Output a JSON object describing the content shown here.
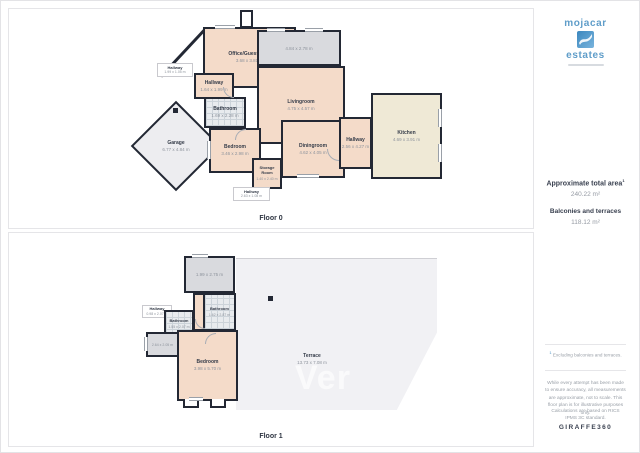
{
  "colors": {
    "wall": "#232834",
    "room_peach": "#f4dbc9",
    "kitchen_cream": "#efe9d6",
    "tile_grey": "#e8ebee",
    "balcony_grey": "#d9dade",
    "terrace_grey": "#f1f1f4",
    "brand_blue": "#4f95c6"
  },
  "floor0": {
    "label": "Floor 0",
    "rooms": {
      "office": {
        "name": "Office/Guestroom",
        "dims": "3.68 x 3.81 m"
      },
      "terrace_top": {
        "dims": "4.84 x 2.78 m"
      },
      "hallway_left": {
        "name": "Hallway",
        "dims": "1.99 x 1.05 m"
      },
      "hallway_small": {
        "name": "Hallway",
        "dims": "1.64 x 1.99 m"
      },
      "bathroom": {
        "name": "Bathroom",
        "dims": "1.69 x 2.28 m"
      },
      "garage": {
        "name": "Garage",
        "dims": "6.77 x 4.84 m"
      },
      "bedroom": {
        "name": "Bedroom",
        "dims": "3.46 x 2.98 m"
      },
      "livingroom": {
        "name": "Livingroom",
        "dims": "4.75 x 4.57 m"
      },
      "diningroom": {
        "name": "Diningroom",
        "dims": "4.62 x 4.05 m"
      },
      "storage": {
        "name": "Storage Room",
        "dims": "1.40 x 2.40 m"
      },
      "hallway_bottom": {
        "name": "Hallway",
        "dims": "2.63 x 1.08 m"
      },
      "hallway_right": {
        "name": "Hallway",
        "dims": "2.56 x 4.27 m"
      },
      "kitchen": {
        "name": "Kitchen",
        "dims": "4.69 x 3.91 m"
      }
    }
  },
  "floor1": {
    "label": "Floor 1",
    "watermark": "Ver",
    "rooms": {
      "balcony_top": {
        "dims": "1.99 x 2.75 m"
      },
      "bathroom_right": {
        "name": "Bathroom",
        "dims": "1.62 x 2.87 m"
      },
      "hallway": {
        "name": "Hallway",
        "dims": "0.98 x 2.07 m"
      },
      "bathroom_left": {
        "name": "Bathroom",
        "dims": "1.55 x 2.07 m"
      },
      "balcony_left": {
        "dims": "2.64 x 2.05 m"
      },
      "bedroom": {
        "name": "Bedroom",
        "dims": "3.98 x 5.70 m"
      },
      "terrace": {
        "name": "Terrace",
        "dims": "13.73 x 7.08 m"
      }
    }
  },
  "sidebar": {
    "logo": {
      "line1": "mojacar",
      "line2": "estates"
    },
    "area": {
      "title": "Approximate total area",
      "sup": "1",
      "value": "240.22 m²",
      "subtitle": "Balconies and terraces",
      "subvalue": "118.12 m²"
    },
    "notes": {
      "sup": "1",
      "text": "Excluding balconies and terraces."
    },
    "disclaimer": "While every attempt has been made to ensure accuracy, all measurements are approximate, not to scale. This floor plan is for illustrative purposes only.",
    "standard": "Calculations are based on RICS IPMS 3C standard.",
    "brand": "GIRAFFE360"
  }
}
